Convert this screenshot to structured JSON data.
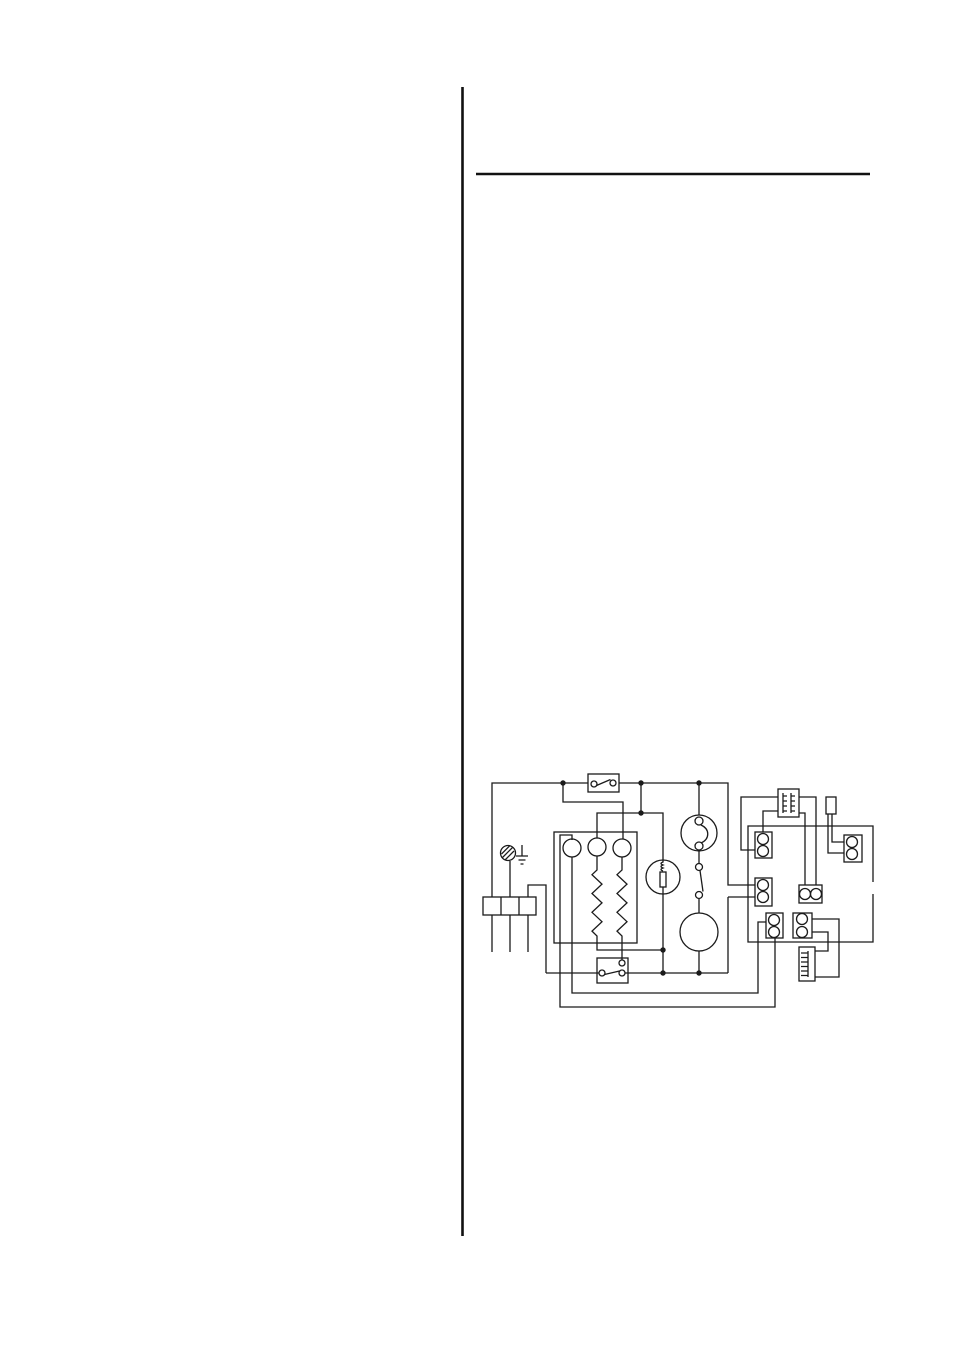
{
  "page": {
    "kind": "scanned-manual-page",
    "description": "Blank manual page with a vertical column rule, a horizontal section rule and an appliance wiring diagram; no printed text is visible",
    "background_color": "#ffffff",
    "ink_color": "#1b1b1b"
  },
  "rules": {
    "vertical_rule": "vertical column separator rule",
    "horizontal_rule": "horizontal section heading rule"
  },
  "diagram": {
    "title": "appliance wiring schematic",
    "aria": "Wiring schematic showing mains terminal block, earth screw, switches, three indicator lamps, two heating elements, neon indicator, thermostat with motor, ignition transformer, fuse link, connector blocks and spark electrode",
    "components": [
      {
        "id": "mains-terminal-block",
        "label": "3-way mains supply terminal block with cable tails"
      },
      {
        "id": "earth-screw",
        "label": "hatched chassis earth screw"
      },
      {
        "id": "earth-symbol",
        "label": "earth ground symbol"
      },
      {
        "id": "main-switch",
        "label": "main on/off switch contact in box"
      },
      {
        "id": "control-unit-box",
        "label": "main unit enclosure"
      },
      {
        "id": "indicator-lamp-1",
        "label": "round indicator / load 1"
      },
      {
        "id": "indicator-lamp-2",
        "label": "round indicator / load 2"
      },
      {
        "id": "indicator-lamp-3",
        "label": "round indicator / load 3"
      },
      {
        "id": "heating-element-1",
        "label": "zig-zag heating element 1"
      },
      {
        "id": "heating-element-2",
        "label": "zig-zag heating element 2"
      },
      {
        "id": "neon-indicator",
        "label": "neon indicator lamp with internal coil"
      },
      {
        "id": "thermostat-sensor",
        "label": "thermostat sensing head with internal contacts"
      },
      {
        "id": "thermostat-contact",
        "label": "thermostat switch blade contact"
      },
      {
        "id": "motor",
        "label": "motor / timer circle"
      },
      {
        "id": "thermal-cutout",
        "label": "thermal cut-out switch in box"
      },
      {
        "id": "ignition-transformer",
        "label": "transformer with twin windings"
      },
      {
        "id": "fuse-link",
        "label": "two-leg fuse link / plug component"
      },
      {
        "id": "connector-a",
        "label": "two-pole connector A"
      },
      {
        "id": "connector-b",
        "label": "two-pole connector B"
      },
      {
        "id": "connector-c",
        "label": "two-pole connector C"
      },
      {
        "id": "connector-d",
        "label": "two-pole connector D"
      },
      {
        "id": "connector-e",
        "label": "two-pole connector E"
      },
      {
        "id": "connector-f",
        "label": "two-pole connector F"
      },
      {
        "id": "spark-electrode",
        "label": "comb-tooth spark electrode block"
      },
      {
        "id": "junctions",
        "label": "solder junction dots"
      }
    ]
  }
}
